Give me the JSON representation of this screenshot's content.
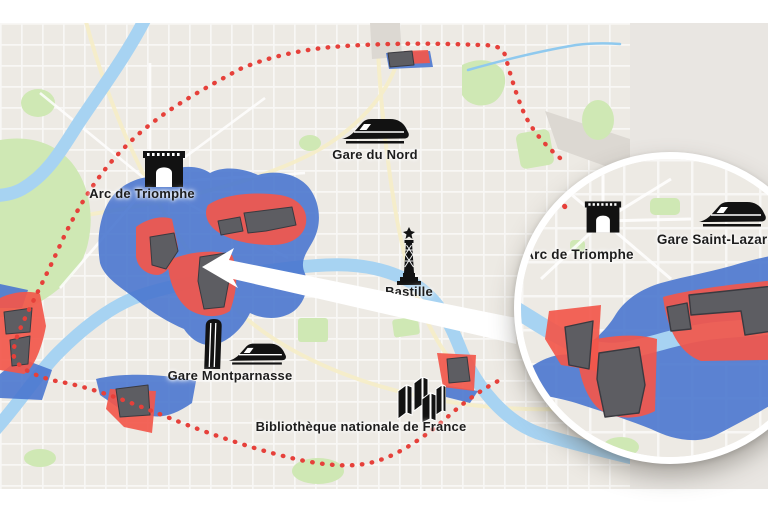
{
  "figure": {
    "type": "city-map-infographic",
    "city": "Paris",
    "boundary_note": "red dotted ring around the city",
    "overlays": [
      "blue zones",
      "red zones",
      "dark building footprints"
    ]
  },
  "landmarks": [
    {
      "id": "gare-du-nord",
      "label": "Gare du Nord",
      "icon": "train-icon"
    },
    {
      "id": "arc-de-triomphe",
      "label": "Arc de Triomphe",
      "icon": "triumphal-arch-icon"
    },
    {
      "id": "bastille",
      "label": "Bastille",
      "icon": "july-column-icon"
    },
    {
      "id": "gare-montparnasse",
      "label": "Gare Montparnasse",
      "icon": "tower-and-train-icon"
    },
    {
      "id": "bibliotheque-nationale-de-france",
      "label": "Bibliothèque nationale de France",
      "icon": "bnf-towers-icon"
    }
  ],
  "inset": {
    "shape": "magnifier-circle",
    "landmarks": [
      {
        "id": "arc-de-triomphe",
        "label": "Arc de Triomphe",
        "icon": "triumphal-arch-icon"
      },
      {
        "id": "gare-saint-lazare",
        "label": "Gare Saint-Lazare",
        "icon": "train-icon"
      }
    ]
  },
  "colors": {
    "zone_blue": "#4a77cf",
    "zone_red": "#f2574b",
    "building_gray": "#5d5d62",
    "boundary_red": "#e6403a",
    "water": "#a7d3f2",
    "park": "#cfe8b4",
    "map_base": "#edeae4",
    "side_panel": "#e9e6e2"
  }
}
